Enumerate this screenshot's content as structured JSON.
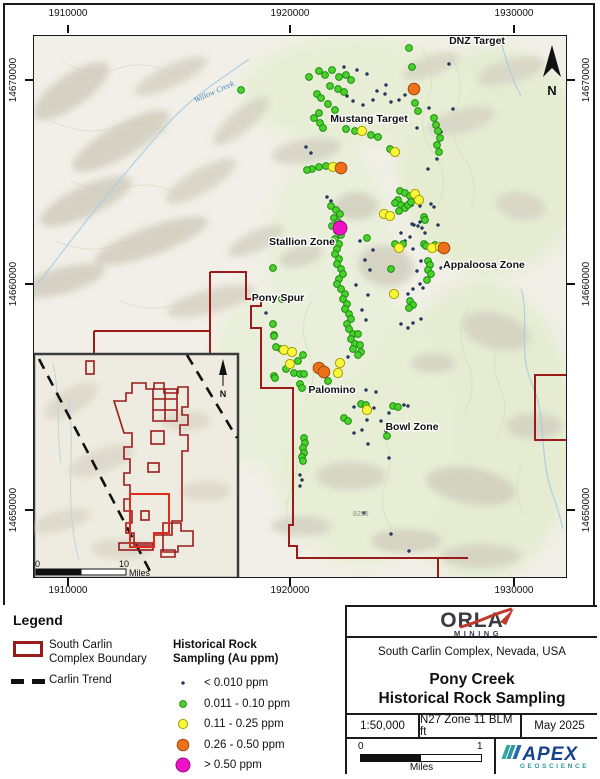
{
  "map": {
    "axis": {
      "top": [
        "1910000",
        "1920000",
        "1930000"
      ],
      "bottom": [
        "1910000",
        "1920000",
        "1930000"
      ],
      "left": [
        "14670000",
        "14660000",
        "14650000"
      ],
      "right": [
        "14670000",
        "14660000",
        "14650000"
      ]
    },
    "zone_labels": [
      {
        "text": "DNZ Target",
        "x": 476,
        "y": 43
      },
      {
        "text": "Mustang Target",
        "x": 368,
        "y": 121
      },
      {
        "text": "Stallion Zone",
        "x": 301,
        "y": 244
      },
      {
        "text": "Appaloosa Zone",
        "x": 483,
        "y": 267
      },
      {
        "text": "Pony Spur",
        "x": 277,
        "y": 300
      },
      {
        "text": "Palomino",
        "x": 331,
        "y": 392
      },
      {
        "text": "Bowl Zone",
        "x": 411,
        "y": 429
      }
    ],
    "creek_label": "Willow Creek",
    "elevation_label": "8295",
    "north_letter": "N",
    "samples": {
      "n": [
        [
          343,
          66
        ],
        [
          356,
          69
        ],
        [
          366,
          73
        ],
        [
          385,
          84
        ],
        [
          376,
          90
        ],
        [
          384,
          93
        ],
        [
          390,
          101
        ],
        [
          398,
          99
        ],
        [
          404,
          94
        ],
        [
          372,
          99
        ],
        [
          362,
          104
        ],
        [
          448,
          63
        ],
        [
          452,
          108
        ],
        [
          428,
          107
        ],
        [
          416,
          127
        ],
        [
          440,
          131
        ],
        [
          436,
          158
        ],
        [
          427,
          168
        ],
        [
          305,
          146
        ],
        [
          310,
          152
        ],
        [
          346,
          95
        ],
        [
          352,
          100
        ],
        [
          411,
          204
        ],
        [
          416,
          201
        ],
        [
          419,
          221
        ],
        [
          413,
          224
        ],
        [
          421,
          227
        ],
        [
          424,
          232
        ],
        [
          409,
          236
        ],
        [
          359,
          240
        ],
        [
          372,
          249
        ],
        [
          364,
          259
        ],
        [
          369,
          269
        ],
        [
          355,
          284
        ],
        [
          367,
          294
        ],
        [
          361,
          309
        ],
        [
          365,
          319
        ],
        [
          419,
          205
        ],
        [
          430,
          203
        ],
        [
          433,
          206
        ],
        [
          411,
          223
        ],
        [
          417,
          225
        ],
        [
          400,
          232
        ],
        [
          437,
          224
        ],
        [
          404,
          240
        ],
        [
          412,
          248
        ],
        [
          420,
          260
        ],
        [
          416,
          270
        ],
        [
          440,
          267
        ],
        [
          419,
          283
        ],
        [
          422,
          287
        ],
        [
          412,
          288
        ],
        [
          407,
          293
        ],
        [
          420,
          318
        ],
        [
          412,
          322
        ],
        [
          407,
          327
        ],
        [
          400,
          323
        ],
        [
          265,
          312
        ],
        [
          365,
          389
        ],
        [
          375,
          391
        ],
        [
          353,
          406
        ],
        [
          373,
          407
        ],
        [
          403,
          404
        ],
        [
          407,
          405
        ],
        [
          361,
          429
        ],
        [
          353,
          432
        ],
        [
          366,
          419
        ],
        [
          367,
          443
        ],
        [
          388,
          412
        ],
        [
          380,
          420
        ],
        [
          385,
          430
        ],
        [
          299,
          474
        ],
        [
          301,
          479
        ],
        [
          299,
          485
        ],
        [
          390,
          533
        ],
        [
          408,
          550
        ],
        [
          363,
          512
        ],
        [
          388,
          457
        ],
        [
          347,
          356
        ],
        [
          326,
          196
        ],
        [
          330,
          200
        ]
      ],
      "g": [
        [
          318,
          70
        ],
        [
          324,
          74
        ],
        [
          331,
          69
        ],
        [
          338,
          76
        ],
        [
          345,
          74
        ],
        [
          350,
          79
        ],
        [
          308,
          76
        ],
        [
          329,
          85
        ],
        [
          337,
          88
        ],
        [
          343,
          91
        ],
        [
          316,
          93
        ],
        [
          320,
          97
        ],
        [
          327,
          103
        ],
        [
          334,
          109
        ],
        [
          318,
          112
        ],
        [
          313,
          117
        ],
        [
          319,
          122
        ],
        [
          322,
          127
        ],
        [
          240,
          89
        ],
        [
          411,
          66
        ],
        [
          408,
          47
        ],
        [
          414,
          102
        ],
        [
          417,
          110
        ],
        [
          433,
          117
        ],
        [
          435,
          124
        ],
        [
          437,
          130
        ],
        [
          439,
          137
        ],
        [
          436,
          144
        ],
        [
          438,
          151
        ],
        [
          345,
          128
        ],
        [
          354,
          130
        ],
        [
          370,
          134
        ],
        [
          377,
          136
        ],
        [
          389,
          148
        ],
        [
          325,
          165
        ],
        [
          318,
          166
        ],
        [
          311,
          168
        ],
        [
          306,
          169
        ],
        [
          399,
          190
        ],
        [
          404,
          192
        ],
        [
          409,
          195
        ],
        [
          397,
          199
        ],
        [
          394,
          202
        ],
        [
          400,
          204
        ],
        [
          404,
          207
        ],
        [
          398,
          210
        ],
        [
          407,
          204
        ],
        [
          410,
          201
        ],
        [
          423,
          216
        ],
        [
          424,
          219
        ],
        [
          330,
          205
        ],
        [
          335,
          209
        ],
        [
          339,
          213
        ],
        [
          333,
          217
        ],
        [
          337,
          221
        ],
        [
          331,
          225
        ],
        [
          336,
          230
        ],
        [
          340,
          234
        ],
        [
          334,
          238
        ],
        [
          338,
          243
        ],
        [
          336,
          248
        ],
        [
          334,
          253
        ],
        [
          338,
          258
        ],
        [
          336,
          263
        ],
        [
          340,
          268
        ],
        [
          342,
          273
        ],
        [
          338,
          278
        ],
        [
          336,
          283
        ],
        [
          340,
          288
        ],
        [
          344,
          293
        ],
        [
          342,
          298
        ],
        [
          346,
          303
        ],
        [
          344,
          308
        ],
        [
          348,
          313
        ],
        [
          350,
          318
        ],
        [
          346,
          323
        ],
        [
          348,
          328
        ],
        [
          352,
          333
        ],
        [
          350,
          338
        ],
        [
          354,
          343
        ],
        [
          352,
          348
        ],
        [
          366,
          237
        ],
        [
          394,
          243
        ],
        [
          402,
          243
        ],
        [
          423,
          243
        ],
        [
          425,
          245
        ],
        [
          434,
          244
        ],
        [
          427,
          260
        ],
        [
          429,
          264
        ],
        [
          427,
          269
        ],
        [
          430,
          273
        ],
        [
          426,
          279
        ],
        [
          390,
          268
        ],
        [
          409,
          300
        ],
        [
          412,
          304
        ],
        [
          408,
          307
        ],
        [
          272,
          267
        ],
        [
          281,
          298
        ],
        [
          272,
          323
        ],
        [
          273,
          334
        ],
        [
          280,
          348
        ],
        [
          273,
          335
        ],
        [
          275,
          346
        ],
        [
          297,
          360
        ],
        [
          302,
          354
        ],
        [
          285,
          368
        ],
        [
          293,
          372
        ],
        [
          299,
          373
        ],
        [
          303,
          373
        ],
        [
          273,
          375
        ],
        [
          274,
          377
        ],
        [
          327,
          380
        ],
        [
          299,
          383
        ],
        [
          301,
          387
        ],
        [
          357,
          333
        ],
        [
          359,
          344
        ],
        [
          360,
          351
        ],
        [
          357,
          354
        ],
        [
          360,
          403
        ],
        [
          365,
          404
        ],
        [
          343,
          417
        ],
        [
          347,
          420
        ],
        [
          392,
          405
        ],
        [
          397,
          406
        ],
        [
          386,
          435
        ],
        [
          303,
          437
        ],
        [
          304,
          442
        ],
        [
          302,
          447
        ],
        [
          303,
          452
        ],
        [
          301,
          456
        ],
        [
          302,
          460
        ]
      ],
      "y": [
        [
          361,
          130
        ],
        [
          394,
          151
        ],
        [
          332,
          166
        ],
        [
          414,
          193
        ],
        [
          418,
          199
        ],
        [
          383,
          213
        ],
        [
          389,
          215
        ],
        [
          398,
          247
        ],
        [
          431,
          247
        ],
        [
          439,
          246
        ],
        [
          393,
          293
        ],
        [
          283,
          349
        ],
        [
          289,
          363
        ],
        [
          291,
          351
        ],
        [
          339,
          362
        ],
        [
          337,
          372
        ],
        [
          366,
          409
        ]
      ],
      "o": [
        [
          413,
          88
        ],
        [
          340,
          167
        ],
        [
          443,
          247
        ],
        [
          318,
          367
        ],
        [
          323,
          371
        ]
      ],
      "m": [
        [
          339,
          227
        ]
      ]
    }
  },
  "inset": {
    "scalebar": {
      "start": "0",
      "end": "10",
      "unit": "Miles"
    },
    "north_letter": "N"
  },
  "legend": {
    "title": "Legend",
    "boundary_label_line1": "South Carlin",
    "boundary_label_line2": "Complex Boundary",
    "trend_label": "Carlin Trend",
    "sampling_title_line1": "Historical Rock",
    "sampling_title_line2": "Sampling (Au ppm)",
    "categories": [
      {
        "key": "n",
        "label": "< 0.010 ppm",
        "fill": "#1e3a68",
        "stroke": "#0d1f40",
        "r": 1.5
      },
      {
        "key": "g",
        "label": "0.011 - 0.10 ppm",
        "fill": "#4ad22b",
        "stroke": "#1e8c14",
        "r": 3.4
      },
      {
        "key": "y",
        "label": "0.11 - 0.25 ppm",
        "fill": "#f8f73a",
        "stroke": "#a8a000",
        "r": 4.6
      },
      {
        "key": "o",
        "label": "0.26 - 0.50 ppm",
        "fill": "#ee7119",
        "stroke": "#a34a0e",
        "r": 5.8
      },
      {
        "key": "m",
        "label": "> 0.50 ppm",
        "fill": "#ef12c4",
        "stroke": "#99108c",
        "r": 7
      }
    ],
    "boundary_color": "#9b1b1b"
  },
  "titleblock": {
    "logo_name": "ORLA",
    "logo_sub": "MINING",
    "region": "South Carlin Complex, Nevada, USA",
    "title_line1": "Pony Creek",
    "title_line2": "Historical Rock Sampling",
    "scale": "1:50,000",
    "projection": "N27 Zone 11 BLM ft",
    "date": "May 2025",
    "scalebar": {
      "start": "0",
      "end": "1",
      "unit": "Miles"
    },
    "apex_name": "APEX",
    "apex_sub": "GEOSCIENCE"
  }
}
